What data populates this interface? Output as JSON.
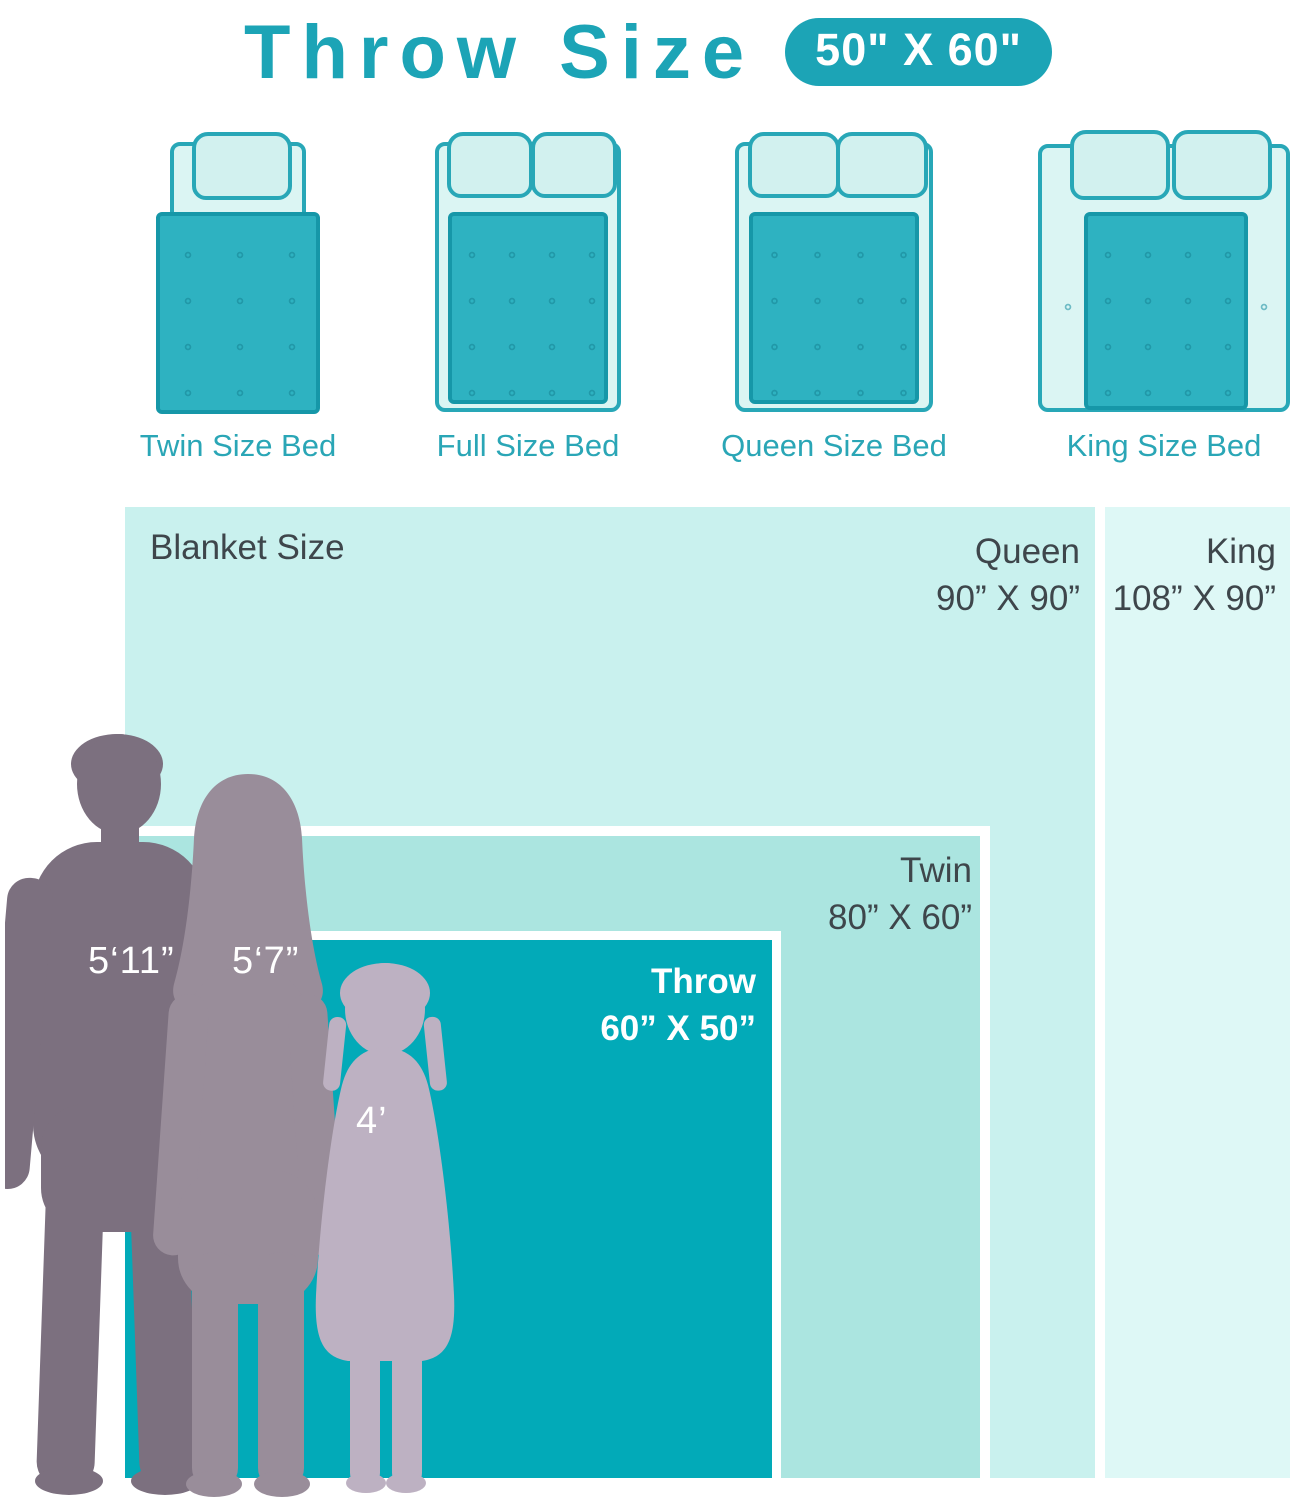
{
  "header": {
    "title": "Throw Size",
    "badge": "50\" X 60\""
  },
  "beds": [
    {
      "label": "Twin Size Bed"
    },
    {
      "label": "Full Size Bed"
    },
    {
      "label": "Queen Size Bed"
    },
    {
      "label": "King Size Bed"
    }
  ],
  "comparison": {
    "section_label": "Blanket Size",
    "sizes": [
      {
        "name": "King",
        "width_in": 108,
        "height_in": 90,
        "dimensions": "108” X 90”"
      },
      {
        "name": "Queen",
        "width_in": 90,
        "height_in": 90,
        "dimensions": "90” X 90”"
      },
      {
        "name": "Twin",
        "width_in": 80,
        "height_in": 60,
        "dimensions": "80” X 60”"
      },
      {
        "name": "Throw",
        "width_in": 60,
        "height_in": 50,
        "dimensions": "60” X 50”"
      }
    ]
  },
  "people": [
    {
      "name": "man",
      "height": "5‘11”"
    },
    {
      "name": "woman",
      "height": "5‘7”"
    },
    {
      "name": "girl",
      "height": "4’"
    }
  ],
  "colors": {
    "teal": "#1CA4B6",
    "throw_fill": "#02AAB8",
    "twin_fill": "#ABE5E0",
    "queen_fill": "#C9F1EE",
    "king_fill": "#DEF8F6",
    "man": "#7C707F",
    "woman": "#998D9A",
    "girl": "#BDB1C2"
  }
}
